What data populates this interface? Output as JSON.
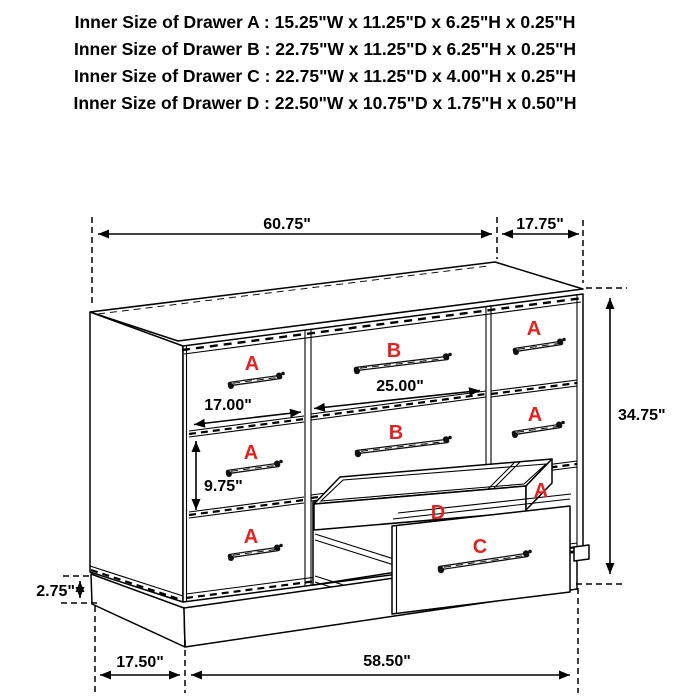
{
  "header": {
    "lines": [
      "Inner Size of Drawer A : 15.25\"W x 11.25\"D x 6.25\"H x 0.25\"H",
      "Inner Size of Drawer B : 22.75\"W x 11.25\"D x 6.25\"H x 0.25\"H",
      "Inner Size of Drawer C : 22.75\"W x 11.25\"D x 4.00\"H x 0.25\"H",
      "Inner Size of Drawer D : 22.50\"W x 10.75\"D x 1.75\"H x 0.50\"H"
    ]
  },
  "dimensions": {
    "top_width": "60.75\"",
    "top_depth": "17.75\"",
    "overall_height": "34.75\"",
    "left_drawer_width": "17.00\"",
    "center_drawer_width": "25.00\"",
    "middle_drawer_height": "9.75\"",
    "base_height": "2.75\"",
    "base_side_depth": "17.50\"",
    "base_front_width": "58.50\""
  },
  "drawer_labels": {
    "left_column": [
      "A",
      "A",
      "A"
    ],
    "center_column": [
      "B",
      "B"
    ],
    "right_column": [
      "A",
      "A",
      "A"
    ],
    "tray": "D",
    "pulled_drawer": "C"
  },
  "colors": {
    "label": "#e32222",
    "line": "#000000",
    "background": "#ffffff"
  }
}
